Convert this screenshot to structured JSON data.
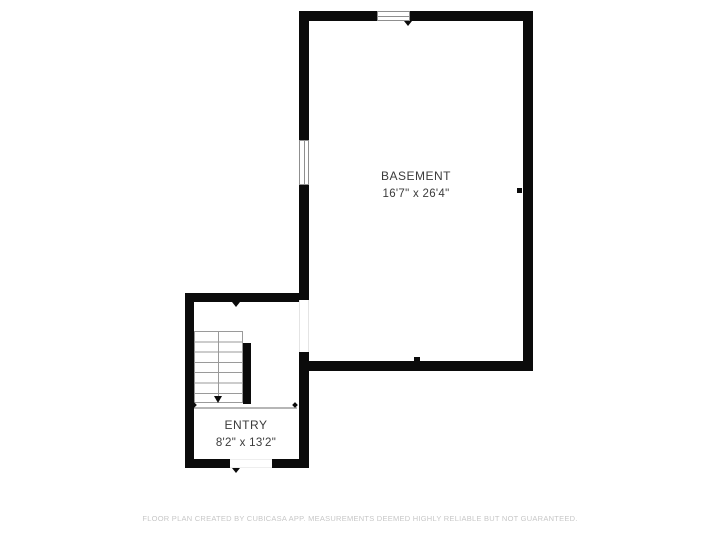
{
  "plan": {
    "rooms": [
      {
        "name": "BASEMENT",
        "dimensions": "16'7\" x 26'4\""
      },
      {
        "name": "ENTRY",
        "dimensions": "8'2\" x 13'2\""
      }
    ],
    "stairs": {
      "treads": 7,
      "direction": "down"
    },
    "window_count": 2,
    "door_opening_count": 2,
    "footer": "FLOOR PLAN CREATED BY CUBICASA APP. MEASUREMENTS DEEMED HIGHLY RELIABLE BUT NOT GUARANTEED."
  },
  "colors": {
    "background": "#ffffff",
    "wall": "#0b0b0b",
    "stair_line": "#9a9a9a",
    "separator": "#b6b6b6",
    "window_frame": "#8f8f8f",
    "label_text": "#3b3b3b",
    "footer_text": "#c7c7c7"
  }
}
